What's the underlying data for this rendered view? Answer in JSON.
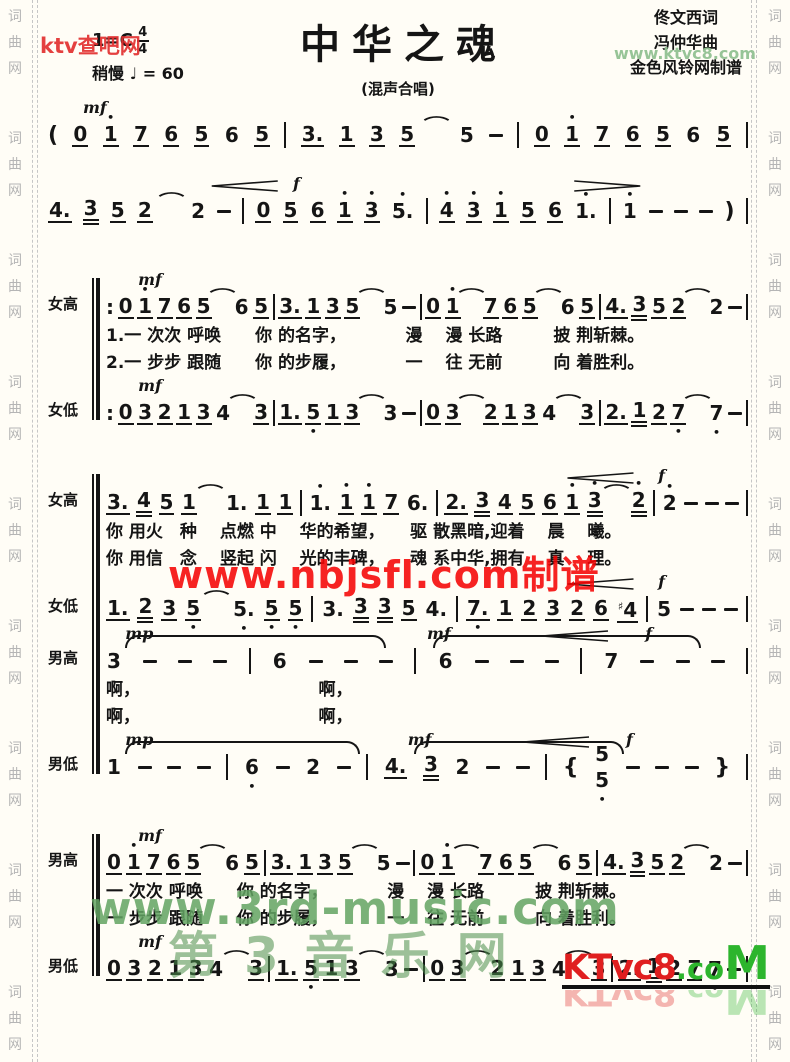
{
  "header": {
    "key": "1=C",
    "time_top": "4",
    "time_bottom": "4",
    "tempo": "稍慢  ♩ = 60",
    "title": "中华之魂",
    "subtitle": "(混声合唱)",
    "credit_lyricist": "佟文西词",
    "credit_composer": "冯仲华曲",
    "credit_transcriber": "金色风铃网制谱"
  },
  "side_text": [
    "词",
    "曲",
    "网"
  ],
  "side_repeats": 9,
  "watermarks": {
    "top_left_red": "ktv查吧网",
    "top_right_green": "www.ktvc8.com",
    "middle_red": "www.nbjsfl.com制谱",
    "bottom_green_en": "www.3rd-music.com",
    "bottom_green_cn": "第3音乐网",
    "logo_red": "KTvc8",
    "logo_dot": ".co",
    "logo_m": "M"
  },
  "colors": {
    "paper": "#fffdf6",
    "ink": "#151515",
    "red_watermark": "#f50505",
    "green_watermark": "#63a463",
    "logo_red": "#e01f1f",
    "logo_green": "#2db52d"
  },
  "music": {
    "sections": [
      {
        "bracket": false,
        "rows": [
          {
            "kind": "notes",
            "label": "",
            "marks": [
              {
                "t": "dyn",
                "v": "mf",
                "x": 5
              }
            ],
            "tokens": "( 0_ 1'_ 7_ 6_ 5_ 6 5_ | 3._ 1_ 3_ 5_ ⌒ 5 - | 0_ 1'_ 7_ 6_ 5_ 6 5_ |"
          },
          {
            "kind": "notes",
            "label": "",
            "marks": [
              {
                "t": "cresc",
                "x": 23,
                "w": 11
              },
              {
                "t": "dyn",
                "v": "f",
                "x": 35
              },
              {
                "t": "decresc",
                "x": 72,
                "w": 17
              }
            ],
            "tokens": "4._ 3= 5_ 2_ ⌒ 2 - | 0_ 5_ 6_ 1'_ 3'_ 5'. | 4'_ 3'_ 1'_ 5_ 6_ 1'. | 1' - - - ) |"
          }
        ]
      },
      {
        "bracket": true,
        "rows": [
          {
            "kind": "notes",
            "label": "女高",
            "marks": [
              {
                "t": "dyn",
                "v": "mf",
                "x": 5
              }
            ],
            "tokens": ": 0_ 1'_ 7_ 6_ 5_ ⌒ 6 5_ | 3._ 1_ 3_ 5_ ⌒ 5 - | 0_ 1'_ ⌒ 7_ 6_ 5_ ⌒ 6 5_ | 4._ 3= 5_ 2_ ⌒ 2 - |"
          },
          {
            "kind": "lyric",
            "text": "1.一 次次 呼唤　　你 的名字，　　　　漫　 漫 长路　　　披 荆斩棘。"
          },
          {
            "kind": "lyric",
            "text": "2.一 步步 跟随　　你 的步履，　　　　一　 往 无前　　　向 着胜利。"
          },
          {
            "kind": "notes",
            "label": "女低",
            "marks": [
              {
                "t": "dyn",
                "v": "mf",
                "x": 5
              }
            ],
            "tokens": ": 0_ 3_ 2_ 1_ 3_ 4 ⌒ 3_ | 1._ 5,_ 1_ 3_ ⌒ 3 - | 0_ 3_ ⌒ 2_ 1_ 3_ 4 ⌒ 3_ | 2._ 1= 2_ 7,_ ⌒ 7, - |"
          }
        ]
      },
      {
        "bracket": true,
        "rows": [
          {
            "kind": "notes",
            "label": "女高",
            "marks": [
              {
                "t": "cresc",
                "x": 70,
                "w": 14
              },
              {
                "t": "dyn",
                "v": "f",
                "x": 86
              }
            ],
            "tokens": "3._ 4= 5_ 1_ ⌒ 1. 1_ 1_ | 1'. 1'_ 1'_ 7_ 6. | 2._ 3= 4_ 5_ 6_ 1'_ 3'= ⌒ 2'= | 2' - - - |"
          },
          {
            "kind": "lyric",
            "text": "你 用火　种　 点燃 中　 华的希望，　　驱 散黑暗,迎着　 晨　 曦。"
          },
          {
            "kind": "lyric",
            "text": "你 用信　念　 竖起 闪　 光的丰碑，　　魂 系中华,拥有　 真　 理。"
          },
          {
            "kind": "notes",
            "label": "女低",
            "marks": [
              {
                "t": "cresc",
                "x": 70,
                "w": 14
              },
              {
                "t": "dyn",
                "v": "f",
                "x": 86
              }
            ],
            "tokens": "1._ 2= 3_ 5,_ ⌒ 5,. 5,_ 5,_ | 3. 3= 3= 5_ 4. | 7,._ 1_ 2_ 3_ 2_ 6_ #4_ | 5 - - - |"
          },
          {
            "kind": "notes",
            "label": "男高",
            "marks": [
              {
                "t": "dyn",
                "v": "mp",
                "x": 3
              },
              {
                "t": "tie",
                "x": 3,
                "w": 40
              },
              {
                "t": "dyn",
                "v": "mf",
                "x": 50
              },
              {
                "t": "tie",
                "x": 51,
                "w": 41
              },
              {
                "t": "cresc",
                "x": 65,
                "w": 16
              },
              {
                "t": "dyn",
                "v": "f",
                "x": 84
              }
            ],
            "tokens": "3 - - - | 6 - - - | 6 - - - | 7 - - - |"
          },
          {
            "kind": "lyric",
            "text": "啊，　　　　　　　　　　　啊，"
          },
          {
            "kind": "lyric",
            "text": "啊，　　　　　　　　　　　啊，"
          },
          {
            "kind": "notes",
            "label": "男低",
            "marks": [
              {
                "t": "dyn",
                "v": "mp",
                "x": 3
              },
              {
                "t": "tie",
                "x": 3,
                "w": 36
              },
              {
                "t": "dyn",
                "v": "mf",
                "x": 47
              },
              {
                "t": "tie",
                "x": 48,
                "w": 32
              },
              {
                "t": "cresc",
                "x": 62,
                "w": 16
              },
              {
                "t": "dyn",
                "v": "f",
                "x": 81
              }
            ],
            "tokens": "1 - - - | 6, - 2 - | 4._ 3= 2 - - | { 5/5, - - - } |"
          }
        ]
      },
      {
        "bracket": true,
        "rows": [
          {
            "kind": "notes",
            "label": "男高",
            "marks": [
              {
                "t": "dyn",
                "v": "mf",
                "x": 5
              }
            ],
            "tokens": "0_ 1'_ 7_ 6_ 5_ ⌒ 6 5_ | 3._ 1_ 3_ 5_ ⌒ 5 - | 0_ 1'_ ⌒ 7_ 6_ 5_ ⌒ 6 5_ | 4._ 3= 5_ 2_ ⌒ 2 - |"
          },
          {
            "kind": "lyric",
            "text": "一 次次 呼唤　　你 的名字，　　　　漫　 漫 长路　　　披 荆斩棘。"
          },
          {
            "kind": "lyric",
            "text": "一 步步 跟随　　你 的步履，　　　　一　 往 无前　　　向 着胜利。"
          },
          {
            "kind": "notes",
            "label": "男低",
            "marks": [
              {
                "t": "dyn",
                "v": "mf",
                "x": 5
              }
            ],
            "tokens": "0_ 3_ 2_ 1_ 3_ 4 ⌒ 3_ | 1._ 5,_ 1_ 3_ ⌒ 3 - | 0_ 3_ ⌒ 2_ 1_ 3_ 4 ⌒ 3_ | 2._ 1= 2_ 7,_ 7, - |"
          }
        ]
      }
    ]
  }
}
